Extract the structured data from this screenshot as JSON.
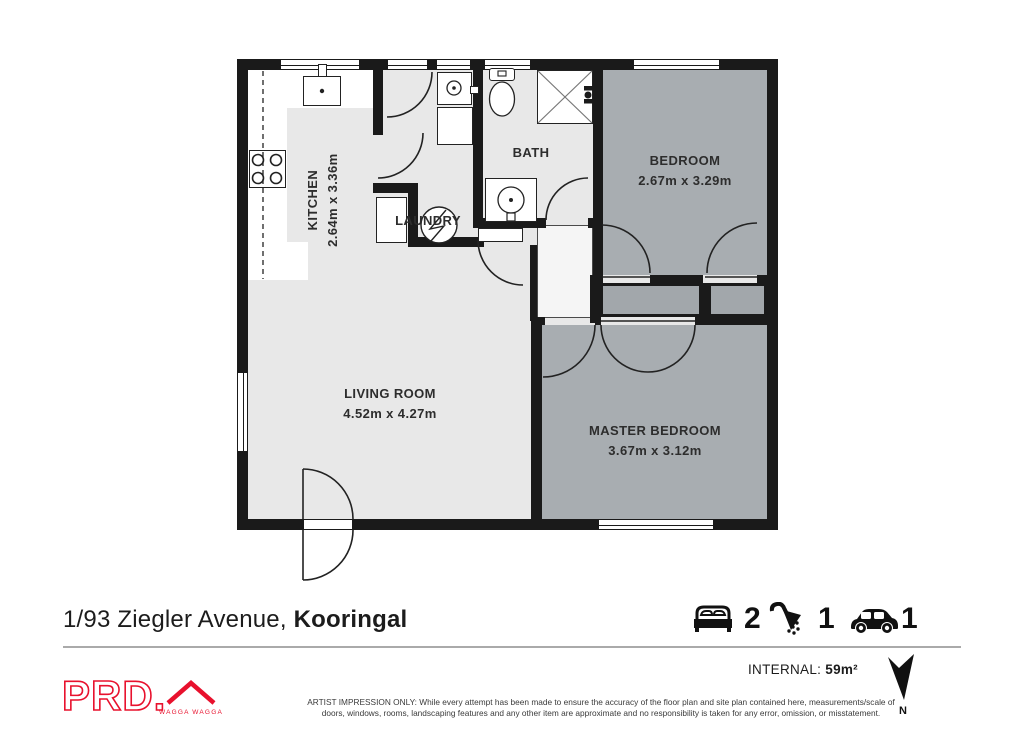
{
  "plan": {
    "rooms": {
      "kitchen": {
        "name": "KITCHEN",
        "dims": "2.64m x 3.36m"
      },
      "laundry": {
        "name": "LAUNDRY"
      },
      "bath": {
        "name": "BATH"
      },
      "bedroom": {
        "name": "BEDROOM",
        "dims": "2.67m x 3.29m"
      },
      "living": {
        "name": "LIVING ROOM",
        "dims": "4.52m x 4.27m"
      },
      "master": {
        "name": "MASTER BEDROOM",
        "dims": "3.67m x 3.12m"
      }
    },
    "north_label": "N"
  },
  "footer": {
    "address_regular": "1/93 Ziegler Avenue, ",
    "address_bold": "Kooringal",
    "bed_count": "2",
    "bath_count": "1",
    "car_count": "1",
    "internal_label": "INTERNAL: ",
    "internal_value": "59m²",
    "disclaimer_line1": "ARTIST IMPRESSION ONLY: While every attempt has been made to ensure the accuracy of the floor plan and site plan contained here, measurements/scale of",
    "disclaimer_line2": "doors, windows, rooms, landscaping features and any other item are approximate and no responsibility is taken for any error, omission, or misstatement."
  },
  "logo": {
    "brand": "PRD.",
    "location": "WAGGA WAGGA"
  },
  "colors": {
    "wall": "#1a1a1a",
    "floor_light": "#e8e8e8",
    "floor_dark": "#a8adb1",
    "brand_red": "#e8112d"
  }
}
